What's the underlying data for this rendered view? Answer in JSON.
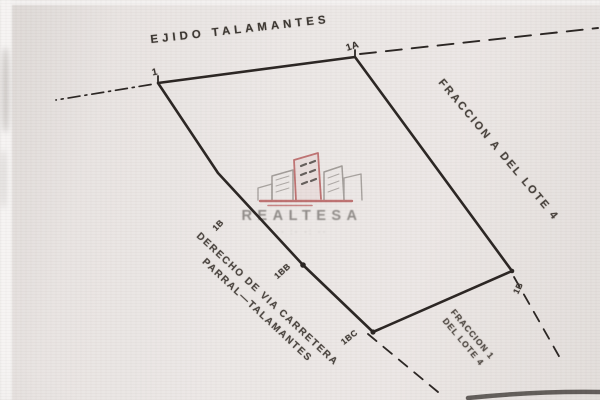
{
  "labels": {
    "ejido": "EJIDO TALAMANTES",
    "fraccion_right": "FRACCION A DEL LOTE 4",
    "derecho_line1": "DERECHO DE VIA CARRETERA",
    "derecho_line2": "PARRAL—TALAMANTES",
    "fraccion_bottom_line1": "FRACCION 1",
    "fraccion_bottom_line2": "DEL LOTE 4"
  },
  "points": {
    "top_left": "1",
    "top_right": "1A",
    "right_corner": "1B",
    "bottom_corner": "1BC",
    "mid_edge_upper": "1B",
    "mid_edge_lower": "1BB"
  },
  "watermark": {
    "brand": "REALTESA",
    "tagline": "·· ː· ·ː ··"
  },
  "colors": {
    "paper": "#eae6e4",
    "ink": "#26211e",
    "brand_red": "#b65c5c",
    "brand_gray": "#8e8a87"
  }
}
